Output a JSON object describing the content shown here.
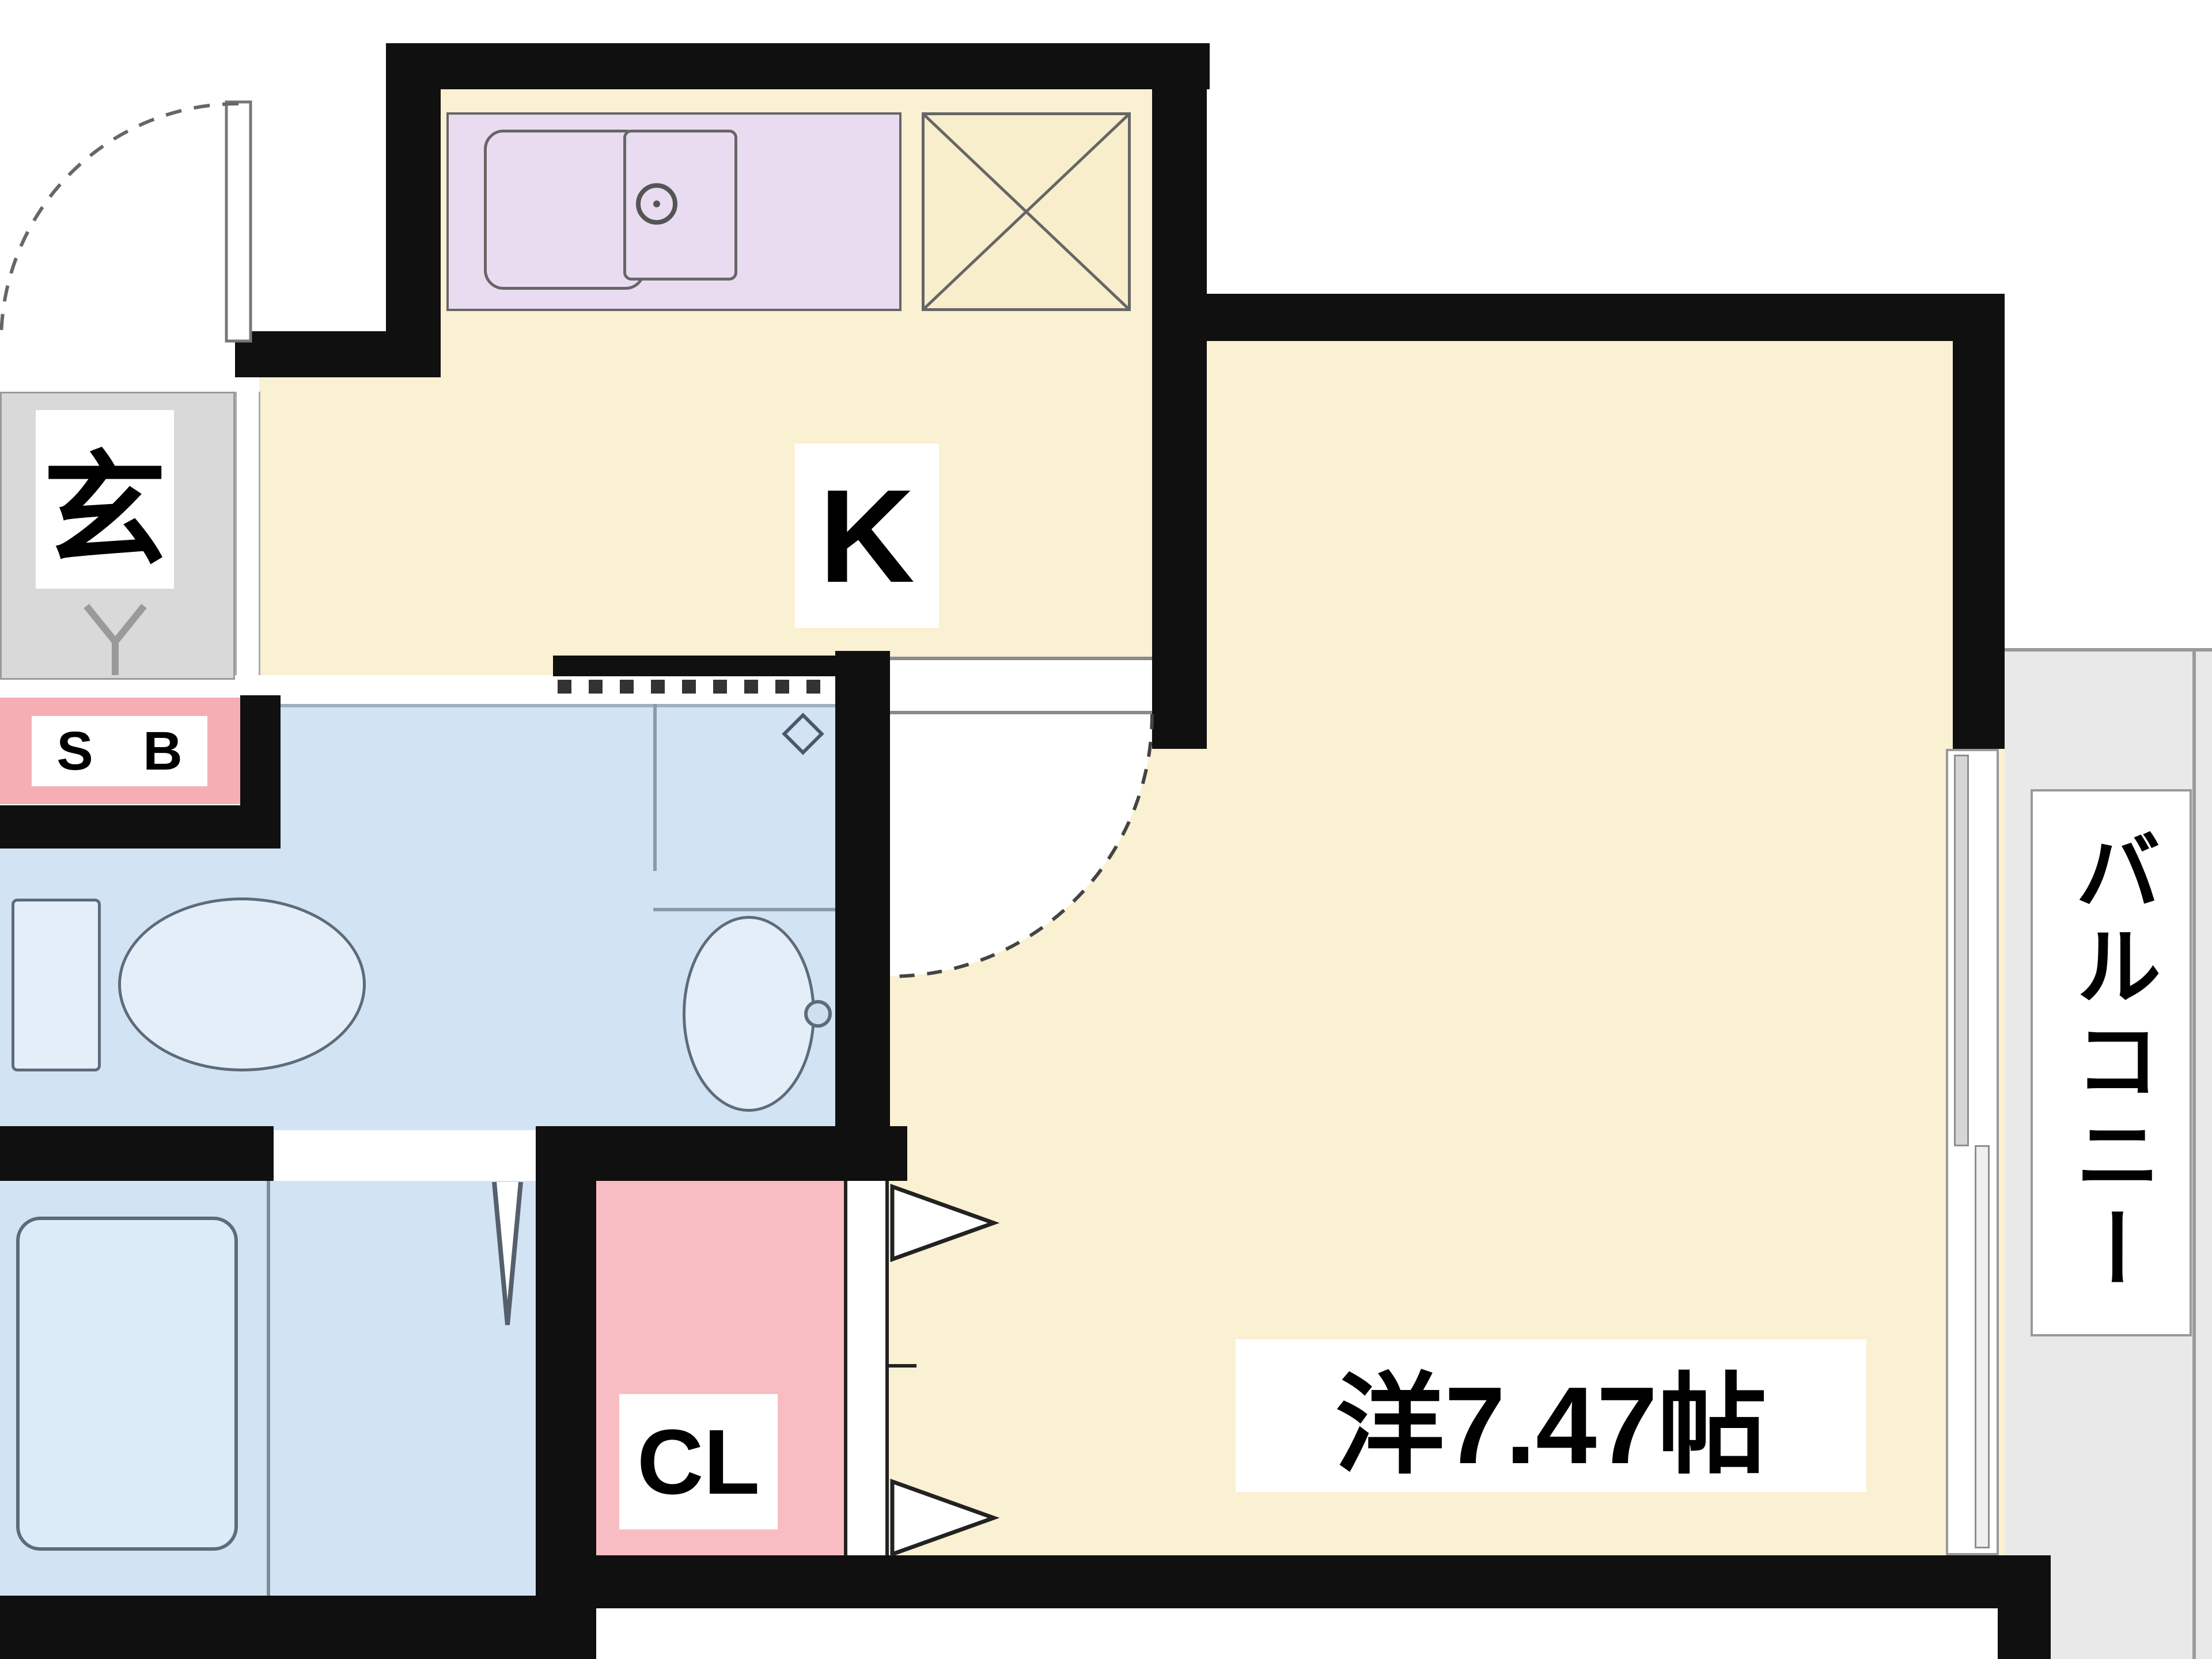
{
  "title": "1K apartment floor plan",
  "colors": {
    "wall": "#101010",
    "floor_cream": "#faf0d2",
    "counter_purple": "#e9dcf1",
    "water_blue": "#d2e3f4",
    "pink": "#f8bdc2",
    "sb_pink": "#f5aeb4",
    "entrance_gray": "#d9d9d9",
    "balcony_gray": "#e9e9e9"
  },
  "rooms": {
    "kitchen": {
      "label": "K"
    },
    "western_room": {
      "label": "洋7.47帖"
    },
    "balcony": {
      "label": "バルコニー"
    },
    "entrance": {
      "label": "玄"
    },
    "shoe_box": {
      "label": "S B"
    },
    "closet": {
      "label": "CL"
    }
  },
  "fixtures": [
    "kitchen-sink",
    "stove",
    "refrigerator-space",
    "toilet",
    "wash-basin",
    "bathtub",
    "sliding-window",
    "entrance-door",
    "room-door",
    "closet-double-door",
    "accordion-partition",
    "faucet"
  ]
}
